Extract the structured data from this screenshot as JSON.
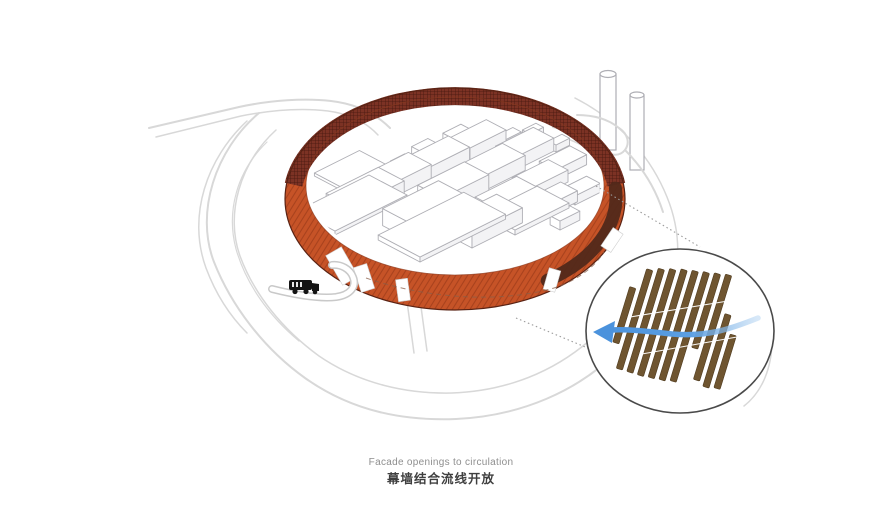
{
  "diagram": {
    "caption": {
      "en": "Facade openings to circulation",
      "zh": "幕墙结合流线开放"
    },
    "colors": {
      "facade_orange": "#c65327",
      "facade_hatch": "#9e3c1a",
      "rim_mesh_base": "#7c3224",
      "rim_mesh_line": "#45180f",
      "ring_shadow": "#52291a",
      "ring_outline": "#5a2314",
      "inner_outline": "#8a3a20",
      "slat_brown": "#6f5530",
      "slat_outline": "#4e3a1e",
      "arrow_blue": "#4b92dc",
      "arrow_blue_light": "#a8cdf0",
      "road_gray": "#d8d8d8",
      "massing_stroke": "#aeaeb4",
      "massing_fill": "#ffffff",
      "massing_side": "#f3f3f5",
      "leader_gray": "#9b9b9b",
      "detail_border": "#4a4a4a",
      "truck_black": "#141414",
      "caption_en_color": "#8e8e8e",
      "caption_zh_color": "#3f3f3f"
    },
    "detail": {
      "slat_count": 11,
      "arrow_direction": "left"
    }
  }
}
